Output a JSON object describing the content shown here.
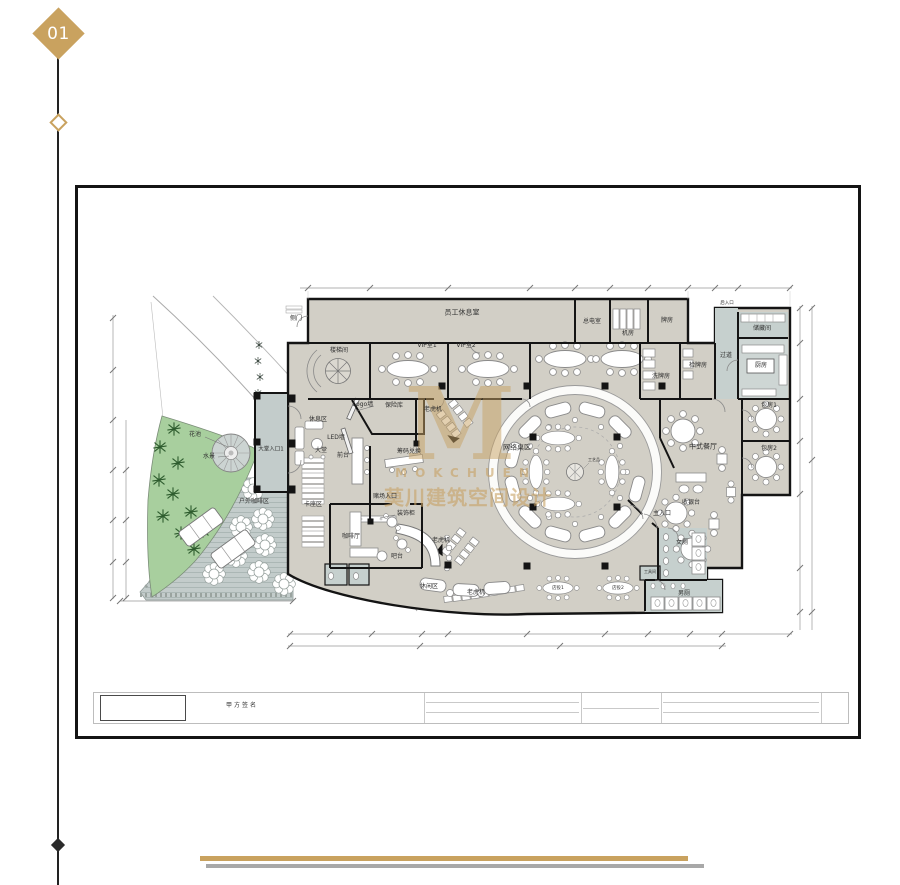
{
  "page": {
    "number": "01"
  },
  "colors": {
    "accent": "#c9a25f",
    "floor": "#d2cfc6",
    "wet_area": "#c6d0ce",
    "outdoor_deck": "#c3cccb",
    "green": "#a8cf9e",
    "wall": "#141414"
  },
  "watermark": {
    "monogram": "M",
    "latin": "MOKCHUEN",
    "chinese": "莫川建筑空间设计"
  },
  "title_block": {
    "label": "甲方签名"
  },
  "plan": {
    "labels": [
      {
        "text": "侧门",
        "x": 296,
        "y": 319,
        "s": 6
      },
      {
        "text": "员工休息室",
        "x": 462,
        "y": 313,
        "s": 7
      },
      {
        "text": "总电室",
        "x": 592,
        "y": 322,
        "s": 6
      },
      {
        "text": "机房",
        "x": 628,
        "y": 334,
        "s": 6
      },
      {
        "text": "牌房",
        "x": 667,
        "y": 321,
        "s": 6
      },
      {
        "text": "后入口",
        "x": 727,
        "y": 304,
        "s": 4.5
      },
      {
        "text": "储藏间",
        "x": 762,
        "y": 329,
        "s": 6
      },
      {
        "text": "过道",
        "x": 726,
        "y": 356,
        "s": 6
      },
      {
        "text": "厨房",
        "x": 761,
        "y": 366,
        "s": 6
      },
      {
        "text": "检牌房",
        "x": 698,
        "y": 366,
        "s": 6
      },
      {
        "text": "洗牌房",
        "x": 661,
        "y": 377,
        "s": 6
      },
      {
        "text": "包房1",
        "x": 769,
        "y": 406,
        "s": 6
      },
      {
        "text": "包房2",
        "x": 769,
        "y": 449,
        "s": 6
      },
      {
        "text": "中式餐厅",
        "x": 703,
        "y": 447,
        "s": 7
      },
      {
        "text": "楼梯间",
        "x": 339,
        "y": 351,
        "s": 6
      },
      {
        "text": "VIP室1",
        "x": 427,
        "y": 346,
        "s": 6
      },
      {
        "text": "VIP室2",
        "x": 466,
        "y": 346,
        "s": 6
      },
      {
        "text": "保险库",
        "x": 394,
        "y": 406,
        "s": 6
      },
      {
        "text": "休息区",
        "x": 318,
        "y": 420,
        "s": 6
      },
      {
        "text": "Logo墙",
        "x": 363,
        "y": 405,
        "s": 6
      },
      {
        "text": "LED墙",
        "x": 336,
        "y": 438,
        "s": 6
      },
      {
        "text": "大堂",
        "x": 321,
        "y": 451,
        "s": 6
      },
      {
        "text": "前台",
        "x": 343,
        "y": 456,
        "s": 6
      },
      {
        "text": "老虎机",
        "x": 433,
        "y": 410,
        "s": 6
      },
      {
        "text": "筹码兑换",
        "x": 409,
        "y": 452,
        "s": 6
      },
      {
        "text": "网络桌区",
        "x": 517,
        "y": 448,
        "s": 7
      },
      {
        "text": "工艺品",
        "x": 594,
        "y": 460,
        "s": 4
      },
      {
        "text": "大堂入口1",
        "x": 271,
        "y": 450,
        "s": 5.5
      },
      {
        "text": "花池",
        "x": 195,
        "y": 435,
        "s": 6
      },
      {
        "text": "水景",
        "x": 209,
        "y": 457,
        "s": 6
      },
      {
        "text": "赌场入口",
        "x": 385,
        "y": 497,
        "s": 6
      },
      {
        "text": "装饰柜",
        "x": 406,
        "y": 514,
        "s": 6
      },
      {
        "text": "卡座区",
        "x": 313,
        "y": 505,
        "s": 6
      },
      {
        "text": "咖啡厅",
        "x": 351,
        "y": 537,
        "s": 6
      },
      {
        "text": "吧台",
        "x": 397,
        "y": 557,
        "s": 6
      },
      {
        "text": "老虎机",
        "x": 441,
        "y": 541,
        "s": 6
      },
      {
        "text": "休闲区",
        "x": 429,
        "y": 587,
        "s": 6
      },
      {
        "text": "户外咖啡区",
        "x": 254,
        "y": 502,
        "s": 6
      },
      {
        "text": "老虎机",
        "x": 476,
        "y": 593,
        "s": 6
      },
      {
        "text": "店投1",
        "x": 558,
        "y": 589,
        "s": 4.5
      },
      {
        "text": "店投2",
        "x": 618,
        "y": 589,
        "s": 4.5
      },
      {
        "text": "收银台",
        "x": 691,
        "y": 503,
        "s": 6
      },
      {
        "text": "主入口",
        "x": 662,
        "y": 514,
        "s": 6
      },
      {
        "text": "女厕",
        "x": 682,
        "y": 543,
        "s": 6
      },
      {
        "text": "工具间",
        "x": 650,
        "y": 572,
        "s": 4
      },
      {
        "text": "男厕",
        "x": 684,
        "y": 594,
        "s": 6
      }
    ]
  }
}
